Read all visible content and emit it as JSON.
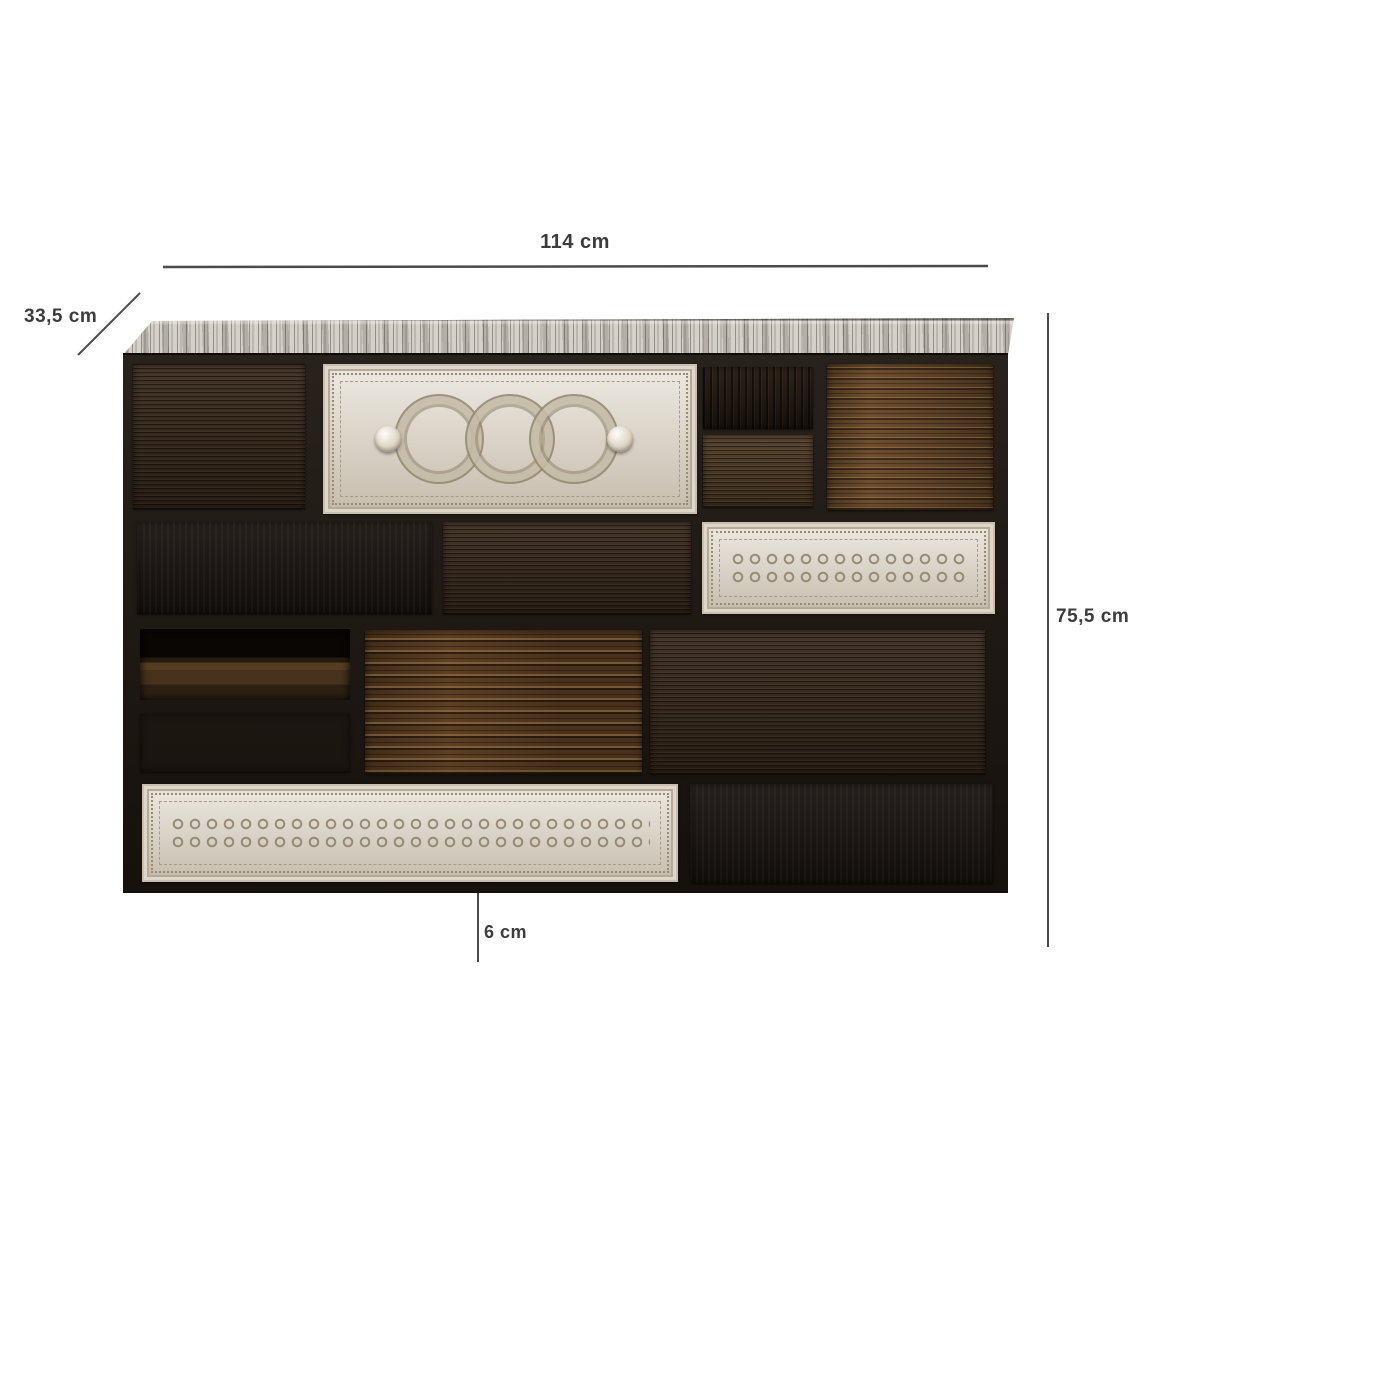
{
  "image": {
    "type": "product-dimension-diagram",
    "background": "#ffffff"
  },
  "dimensions": {
    "width": {
      "label": "114 cm"
    },
    "depth": {
      "label": "33,5 cm"
    },
    "height": {
      "label": "75,5 cm"
    },
    "leg_height": {
      "label": "6 cm"
    },
    "line_color": "#4a4a4a",
    "text_color": "#3c3c3c"
  },
  "furniture": {
    "name": "vintage patchwork chest of drawers",
    "palette": {
      "frame": "#1d1610",
      "whitewash_top": "#d5d1c9",
      "white_carved": "#d9d1c2",
      "espresso": "#38291c",
      "black": "#1a1410",
      "driftwood": "#6e4e2f",
      "copper_handle": "#c98b63",
      "pewter_handle": "#8f8f8f",
      "brass_knob": "#b08c49",
      "porcelain_knob": "#efece5"
    },
    "drawers": [
      {
        "id": "r1-left",
        "finish": "espresso",
        "handle": "cutout",
        "x": 10,
        "y": 9,
        "w": 172,
        "h": 145
      },
      {
        "id": "r1-center-white",
        "finish": "white-carved",
        "decor": "medallions",
        "x": 200,
        "y": 9,
        "w": 374,
        "h": 150
      },
      {
        "id": "r1-small-top",
        "finish": "espresso-dark",
        "handle": "keyhole",
        "hx": 0.47,
        "hy": 0.55,
        "x": 580,
        "y": 12,
        "w": 110,
        "h": 62
      },
      {
        "id": "r1-small-bottom",
        "finish": "brown-grain",
        "handle": "keyhole",
        "hx": 0.49,
        "hy": 0.6,
        "x": 580,
        "y": 80,
        "w": 110,
        "h": 72
      },
      {
        "id": "r1-right-driftwood",
        "finish": "driftwood",
        "handle": "porcelain",
        "hx": 0.56,
        "hy": 0.43,
        "x": 704,
        "y": 9,
        "w": 166,
        "h": 146
      },
      {
        "id": "r2-left-black",
        "finish": "black",
        "handle": "copper-cup",
        "hx": 0.485,
        "hy": 0.56,
        "x": 14,
        "y": 167,
        "w": 295,
        "h": 92
      },
      {
        "id": "r2-center-espresso",
        "finish": "espresso",
        "handle": "porcelain-small",
        "hx": 0.445,
        "hy": 0.55,
        "x": 320,
        "y": 167,
        "w": 248,
        "h": 92
      },
      {
        "id": "r2-right-white",
        "finish": "white-carved",
        "decor": "band",
        "x": 579,
        "y": 167,
        "w": 293,
        "h": 92
      },
      {
        "id": "r3-slot-top",
        "finish": "open-slot-brown",
        "x": 17,
        "y": 274,
        "w": 210,
        "h": 71
      },
      {
        "id": "r3-slot-bottom",
        "finish": "open-slot-black",
        "x": 17,
        "y": 359,
        "w": 210,
        "h": 58
      },
      {
        "id": "r3-center-driftwood",
        "finish": "driftwood-heavy",
        "handle": "pewter-cup",
        "hx": 0.47,
        "hy": 0.45,
        "x": 242,
        "y": 275,
        "w": 277,
        "h": 144
      },
      {
        "id": "r3-right-dark",
        "finish": "espresso",
        "handle": "cutout",
        "x": 527,
        "y": 275,
        "w": 335,
        "h": 144
      },
      {
        "id": "r4-white",
        "finish": "white-carved",
        "decor": "band",
        "handle": "double-brass",
        "hx1": 0.19,
        "hx2": 0.8,
        "hy": 0.5,
        "x": 19,
        "y": 429,
        "w": 536,
        "h": 98
      },
      {
        "id": "r4-black",
        "finish": "black",
        "handle": "copper-cup",
        "hx": 0.505,
        "hy": 0.57,
        "x": 567,
        "y": 429,
        "w": 303,
        "h": 99
      }
    ],
    "decor_fractions": {
      "medallions": [
        0.31,
        0.5,
        0.67
      ],
      "domes": [
        0.175,
        0.795
      ]
    }
  }
}
